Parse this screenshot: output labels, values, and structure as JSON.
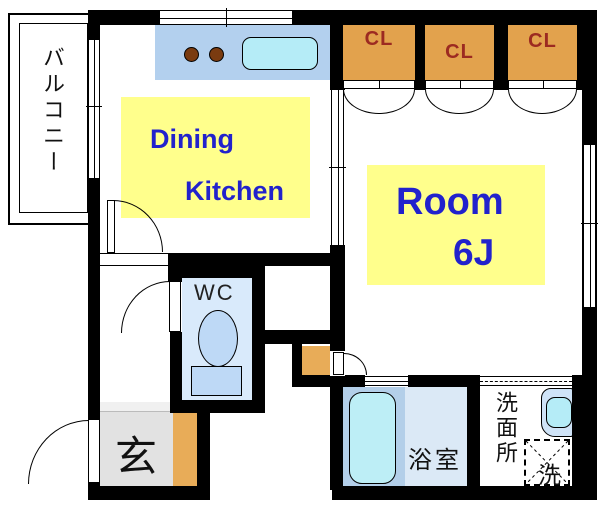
{
  "plan_title": "1K apartment floor plan",
  "rooms": {
    "balcony_label": "バルコニー",
    "dining_label": "Dining",
    "kitchen_label": "Kitchen",
    "room_label": "Room",
    "room_size": "6J",
    "closet1_label": "CL",
    "closet2_label": "CL",
    "closet3_label": "CL",
    "wc_label": "WC",
    "entrance_label": "玄",
    "bathroom_label": "浴室",
    "washroom_label": "洗面所",
    "laundry_label": "洗"
  },
  "colors": {
    "wall": "#000000",
    "highlight_yellow": "#ffff8c",
    "label_blue": "#2222cc",
    "closet_fill": "#e2a24d",
    "closet_text": "#9c2a21",
    "kitchen_counter": "#b3d0ee",
    "fixture_cyan": "#b5ecf7",
    "burner_brown": "#7a3b10",
    "wc_floor": "#d9eafb",
    "toilet_blue": "#bed9f6",
    "entrance_gray": "#e2e2e2",
    "step_orange": "#e8ac58",
    "bath_floor_left": "#b3cfe9",
    "bath_floor_right": "#dbe9f6",
    "vanity_blue": "#cfe3f7"
  }
}
